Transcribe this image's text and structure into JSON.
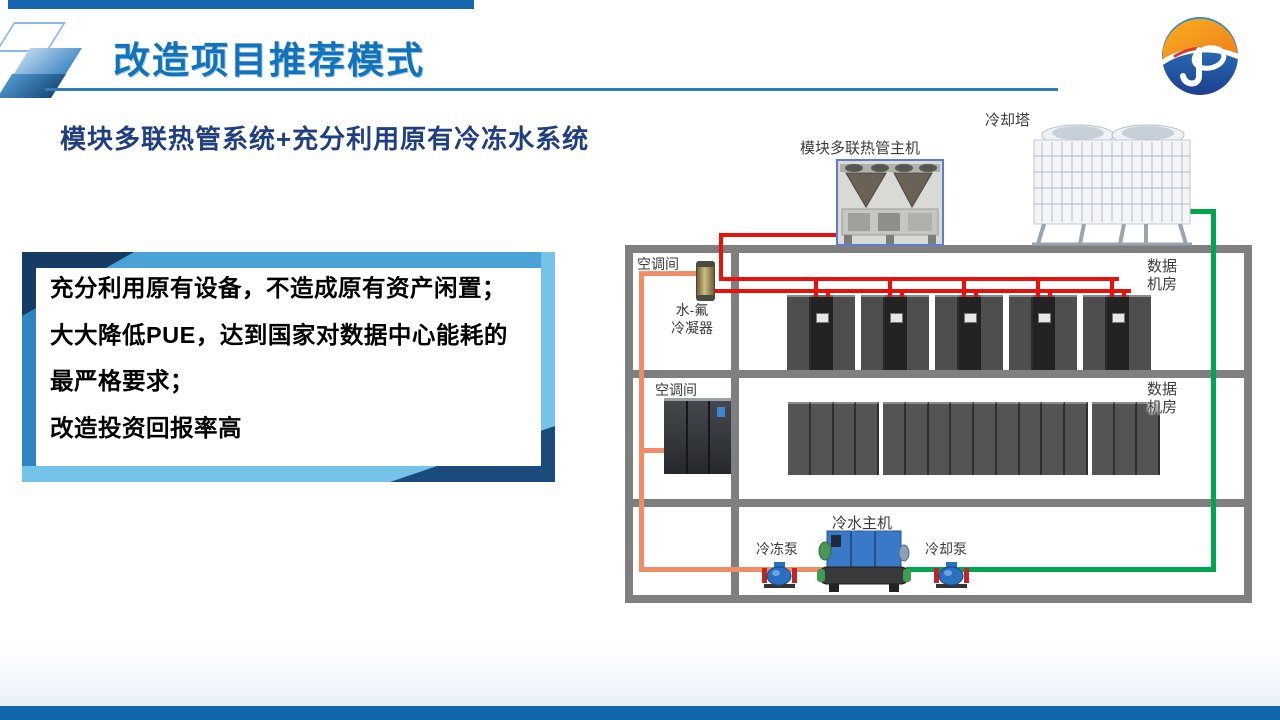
{
  "header": {
    "title": "改造项目推荐模式"
  },
  "subtitle": "模块多联热管系统+充分利用原有冷冻水系统",
  "benefits_box": {
    "lines": [
      "充分利用原有设备，不造成原有资产闲置；",
      "大大降低PUE，达到国家对数据中心能耗的",
      "最严格要求；",
      "改造投资回报率高"
    ]
  },
  "diagram": {
    "labels": {
      "heat_pipe_unit": "模块多联热管主机",
      "cooling_tower": "冷却塔",
      "ac_room_floor1": "空调间",
      "condenser": [
        "水-氟",
        "冷凝器"
      ],
      "data_room_floor1": [
        "数据",
        "机房"
      ],
      "ac_room_floor2": "空调间",
      "data_room_floor2": [
        "数据",
        "机房"
      ],
      "chiller": "冷水主机",
      "chilled_pump": "冷冻泵",
      "cooling_pump": "冷却泵"
    },
    "pipe_colors": {
      "refrigerant_line": "#e8120c",
      "cooling_water_line": "#00a54f",
      "chilled_water_line": "#f08d66",
      "building_frame": "#7f7f7f"
    }
  },
  "colors": {
    "title_blue": "#1273bb",
    "subtitle_navy": "#203f80",
    "top_bar_blue": "#1667b1",
    "bottom_bar_blue": "#1266ae",
    "box_border_blue": "#2e86c0",
    "box_border_light": "#74c4ea",
    "box_border_navy": "#173c64"
  }
}
